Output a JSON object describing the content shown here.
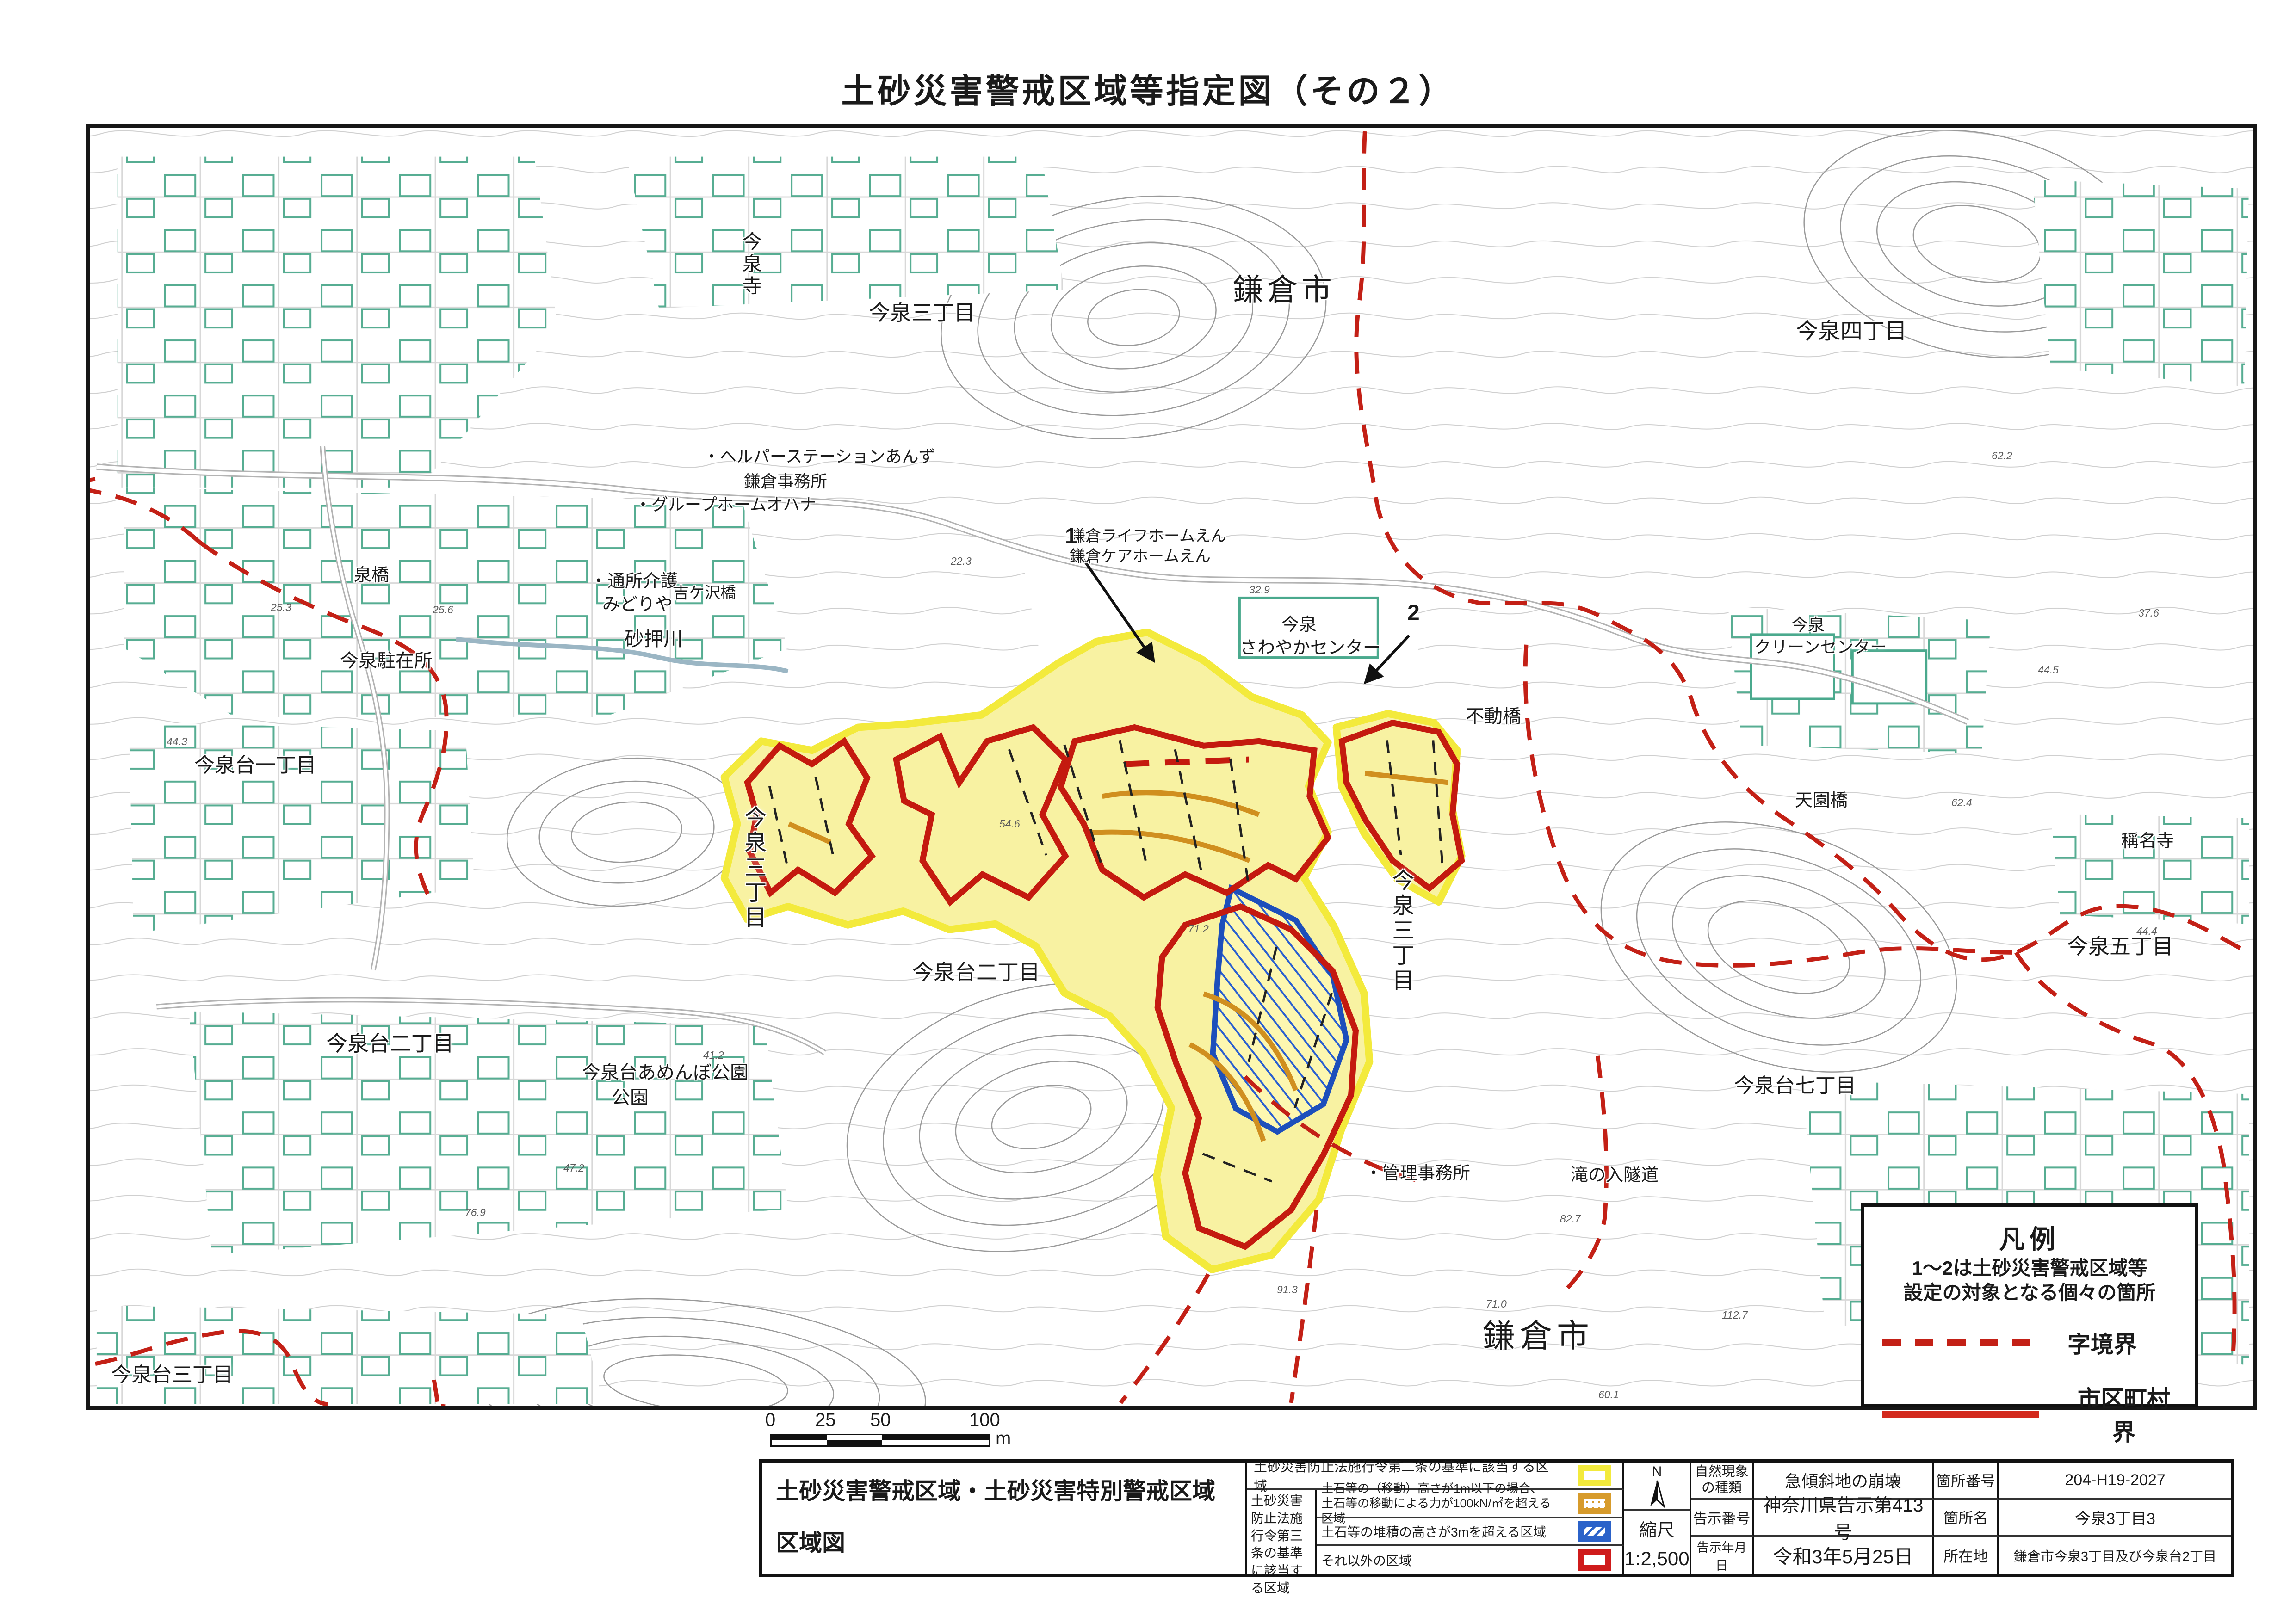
{
  "page": {
    "title": "土砂災害警戒区域等指定図（その２）"
  },
  "map": {
    "labels": [
      {
        "text": "今泉寺"
      },
      {
        "text": "今泉三丁目"
      },
      {
        "text": "鎌倉市"
      },
      {
        "text": "今泉四丁目"
      },
      {
        "text": "・ヘルパーステーションあんず"
      },
      {
        "text": "鎌倉事務所"
      },
      {
        "text": "・グループホームオハナ"
      },
      {
        "text": "鎌倉ライフホームえん"
      },
      {
        "text": "鎌倉ケアホームえん"
      },
      {
        "text": "今泉"
      },
      {
        "text": "さわやかセンター"
      },
      {
        "text": "泉橋"
      },
      {
        "text": "今泉駐在所"
      },
      {
        "text": "今泉台一丁目"
      },
      {
        "text": "・通所介護"
      },
      {
        "text": "みどりや"
      },
      {
        "text": "吉ケ沢橋"
      },
      {
        "text": "砂押川"
      },
      {
        "text": "不動橋"
      },
      {
        "text": "今泉"
      },
      {
        "text": "クリーンセンター"
      },
      {
        "text": "天園橋"
      },
      {
        "text": "稱名寺"
      },
      {
        "text": "今泉三丁目"
      },
      {
        "text": "今泉三丁目"
      },
      {
        "text": "今泉五丁目"
      },
      {
        "text": "今泉台二丁目"
      },
      {
        "text": "今泉台あめんぼ公園"
      },
      {
        "text": "公園"
      },
      {
        "text": "今泉台二丁目"
      },
      {
        "text": "今泉台七丁目"
      },
      {
        "text": "・管理事務所"
      },
      {
        "text": "滝の入隧道"
      },
      {
        "text": "鎌倉市"
      },
      {
        "text": "今泉台三丁目"
      }
    ],
    "markers": [
      {
        "text": "1"
      },
      {
        "text": "2"
      }
    ],
    "spot_elevations": [
      {
        "v": "25.3"
      },
      {
        "v": "25.6"
      },
      {
        "v": "44.3"
      },
      {
        "v": "22.3"
      },
      {
        "v": "32.9"
      },
      {
        "v": "54.6"
      },
      {
        "v": "71.2"
      },
      {
        "v": "41.2"
      },
      {
        "v": "47.2"
      },
      {
        "v": "76.9"
      },
      {
        "v": "82.7"
      },
      {
        "v": "71.0"
      },
      {
        "v": "112.7"
      },
      {
        "v": "60.1"
      },
      {
        "v": "91.3"
      },
      {
        "v": "62.2"
      },
      {
        "v": "37.6"
      },
      {
        "v": "44.5"
      },
      {
        "v": "62.4"
      },
      {
        "v": "44.4"
      }
    ]
  },
  "legend_box": {
    "title": "凡例",
    "line1": "1〜2は土砂災害警戒区域等",
    "line2": "設定の対象となる個々の箇所",
    "dashed_label": "字境界",
    "solid_label": "市区町村界"
  },
  "scalebar": {
    "t0": "0",
    "t25": "25",
    "t50": "50",
    "t100": "100",
    "unit": "m"
  },
  "table": {
    "title_line1": "土砂災害警戒区域・土砂災害特別警戒区域",
    "title_line2": "区域図",
    "row1": "土砂災害防止法施行令第二条の基準に該当する区域",
    "group_label": "土砂災害防止法施行令第三条の基準に該当する区域",
    "row2_line1": "土石等の（移動）高さが1m以下の場合、",
    "row2_line2": "土石等の移動による力が100kN/㎡を超える区域",
    "row3": "土石等の堆積の高さが3mを超える区域",
    "row4": "それ以外の区域",
    "compass_n": "N",
    "scale_label": "縮尺",
    "scale_value": "1:2,500",
    "nature_label": "自然現象の種類",
    "nature_value": "急傾斜地の崩壊",
    "notice_label": "告示番号",
    "notice_value": "神奈川県告示第413号",
    "date_label": "告示年月日",
    "date_value": "令和3年5月25日",
    "site_no_label": "箇所番号",
    "site_no_value": "204-H19-2027",
    "site_name_label": "箇所名",
    "site_name_value": "今泉3丁目3",
    "location_label": "所在地",
    "location_value": "鎌倉市今泉3丁目及び今泉台2丁目"
  },
  "colors": {
    "zone_yellow_border": "#f3ea3c",
    "zone_yellow_fill": "#f8f2a2",
    "zone_orange": "#d08f1f",
    "zone_blue": "#1d4fbb",
    "zone_red": "#c41a0f",
    "boundary_red_dashed": "#c32016",
    "building_teal": "#56ad92"
  }
}
